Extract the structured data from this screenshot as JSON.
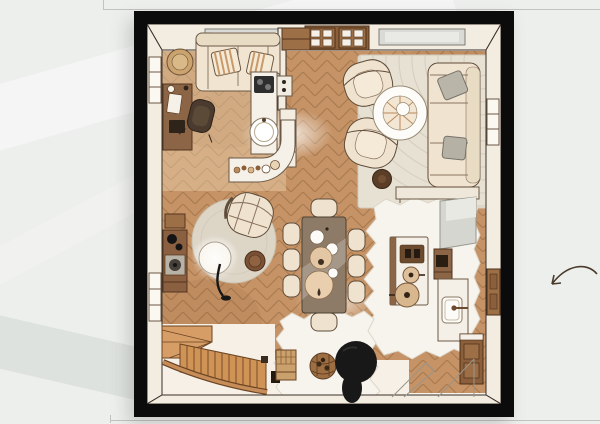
{
  "scene": {
    "type": "framed floor-plan illustration",
    "description": "Hand-drawn watercolor top-down floor plan of an open-plan home in a thick black frame on a pale grey textured wall",
    "colors": {
      "background": "#edefed",
      "frame": "#0b0b0b",
      "paper": "#f8f3ec",
      "wood_floor": "#c69366",
      "wood_lines": "#a97b50",
      "wall_cream": "#f3ece1",
      "furniture_cream": "#efe3cf",
      "furniture_brown": "#8b6546",
      "stairs_wood": "#cf9355",
      "grey_cushion": "#b9b5a9",
      "rug_grey": "#e7e1d4",
      "sheepskin_white": "#f7f4ee",
      "black_accent": "#181818",
      "arrow_ink": "#4a3b2d"
    },
    "rooms": [
      "home office nook",
      "living room",
      "kitchen",
      "dining area",
      "stair hall"
    ],
    "furniture": [
      "office sofa with striped pillows",
      "round side table",
      "wall desk",
      "office chair",
      "partition wall with cabinet and bookshelf",
      "kitchen counter with cooktop",
      "round sink",
      "curved peninsula counter with jars",
      "wood stove sideboard",
      "barrel lounge chair",
      "round pouf",
      "arc floor lamp",
      "round area rug",
      "dining table with place settings",
      "eight dining chairs",
      "kitchen island with two pots",
      "tall grey cabinet",
      "wall cabinets",
      "counter with sink and faucet",
      "console table",
      "three-seat sofa with grey pillows",
      "two swivel armchairs",
      "spiral round coffee table",
      "large striped area rug",
      "two sheepskin rugs",
      "winder staircase with railing",
      "slatted storage crate",
      "log basket",
      "black sculptural planter",
      "bottom-right cabinet",
      "door swing marks",
      "windows",
      "double glass door"
    ],
    "annotation": "curved hand-drawn arrow on the wall pointing toward the plan"
  }
}
